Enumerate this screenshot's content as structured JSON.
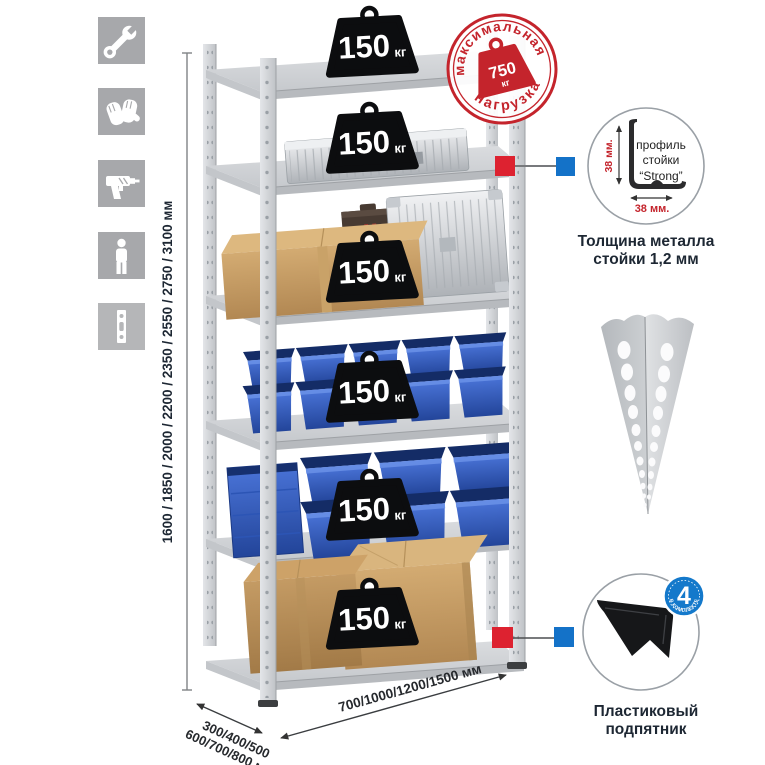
{
  "sidebar": {
    "icons": [
      {
        "name": "wrench"
      },
      {
        "name": "gloves"
      },
      {
        "name": "drill"
      },
      {
        "name": "person"
      },
      {
        "name": "rack-post"
      }
    ]
  },
  "weights": {
    "items": [
      {
        "value": "150",
        "unit": "кг"
      },
      {
        "value": "150",
        "unit": "кг"
      },
      {
        "value": "150",
        "unit": "кг"
      },
      {
        "value": "150",
        "unit": "кг"
      },
      {
        "value": "150",
        "unit": "кг"
      },
      {
        "value": "150",
        "unit": "кг"
      }
    ]
  },
  "stamp": {
    "arc_top": "максимальная",
    "arc_bottom": "нагрузка",
    "value": "750",
    "unit": "кг"
  },
  "dims": {
    "height": "1600 / 1850 / 2000 / 2200 / 2350 / 2550 / 2750 / 3100 мм",
    "depth1": "300/400/500",
    "depth2": "600/700/800 мм",
    "width": "700/1000/1200/1500 мм"
  },
  "profile": {
    "line1": "профиль",
    "line2": "стойки",
    "line3": "“Strong”",
    "dim_v": "38 мм.",
    "dim_h": "38 мм.",
    "cap1": "Толщина металла",
    "cap2": "стойки 1,2 мм"
  },
  "foot": {
    "badge": "4",
    "badge_arc": "В КОМПЛЕКТЕ",
    "cap1": "Пластиковый",
    "cap2": "подпятник"
  },
  "colors": {
    "stamp_red": "#c4242c",
    "marker_red": "#dd2230",
    "marker_blue": "#1472c8",
    "badge_blue": "#1479cb",
    "bin_blue": "#2c58c0",
    "icon_bg": "#a7a8ab",
    "metal": "#cfd2d6"
  }
}
